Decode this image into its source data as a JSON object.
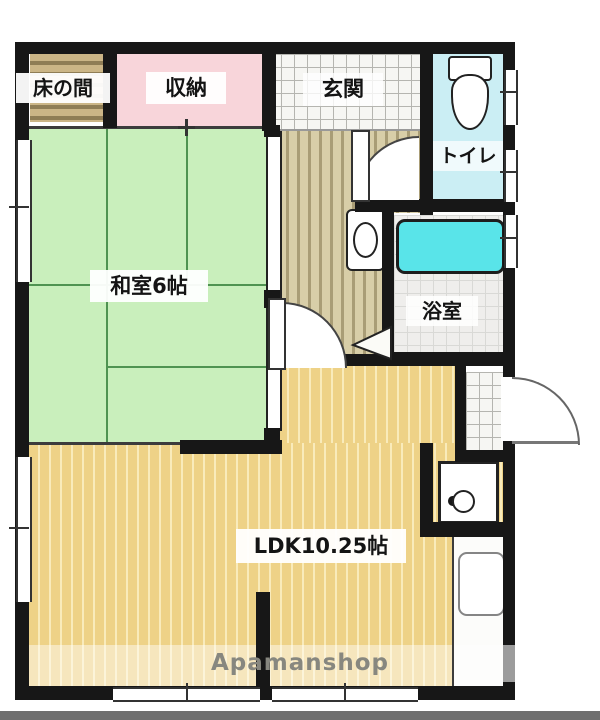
{
  "floorplan": {
    "rooms": {
      "tokonoma": {
        "label": "床の間"
      },
      "storage": {
        "label": "収納"
      },
      "entrance_hall": {
        "label": "玄関"
      },
      "toilet": {
        "label": "トイレ"
      },
      "japanese_room": {
        "label": "和室6帖"
      },
      "bathroom": {
        "label": "浴室"
      },
      "ldk": {
        "label": "LDK10.25帖"
      }
    },
    "watermark": "Apamanshop",
    "colors": {
      "tatami_green": "#c9efbc",
      "storage_pink": "#f8d5da",
      "toilet_cyan": "#cbeef4",
      "bathtub_cyan": "#59e4e9",
      "wood_floor_tan": "#eed287",
      "hallway_tan": "#d8cea8",
      "tokonoma_brown": "#cbb586",
      "wall_black": "#171717",
      "watermark_gray": "#87877f"
    }
  }
}
